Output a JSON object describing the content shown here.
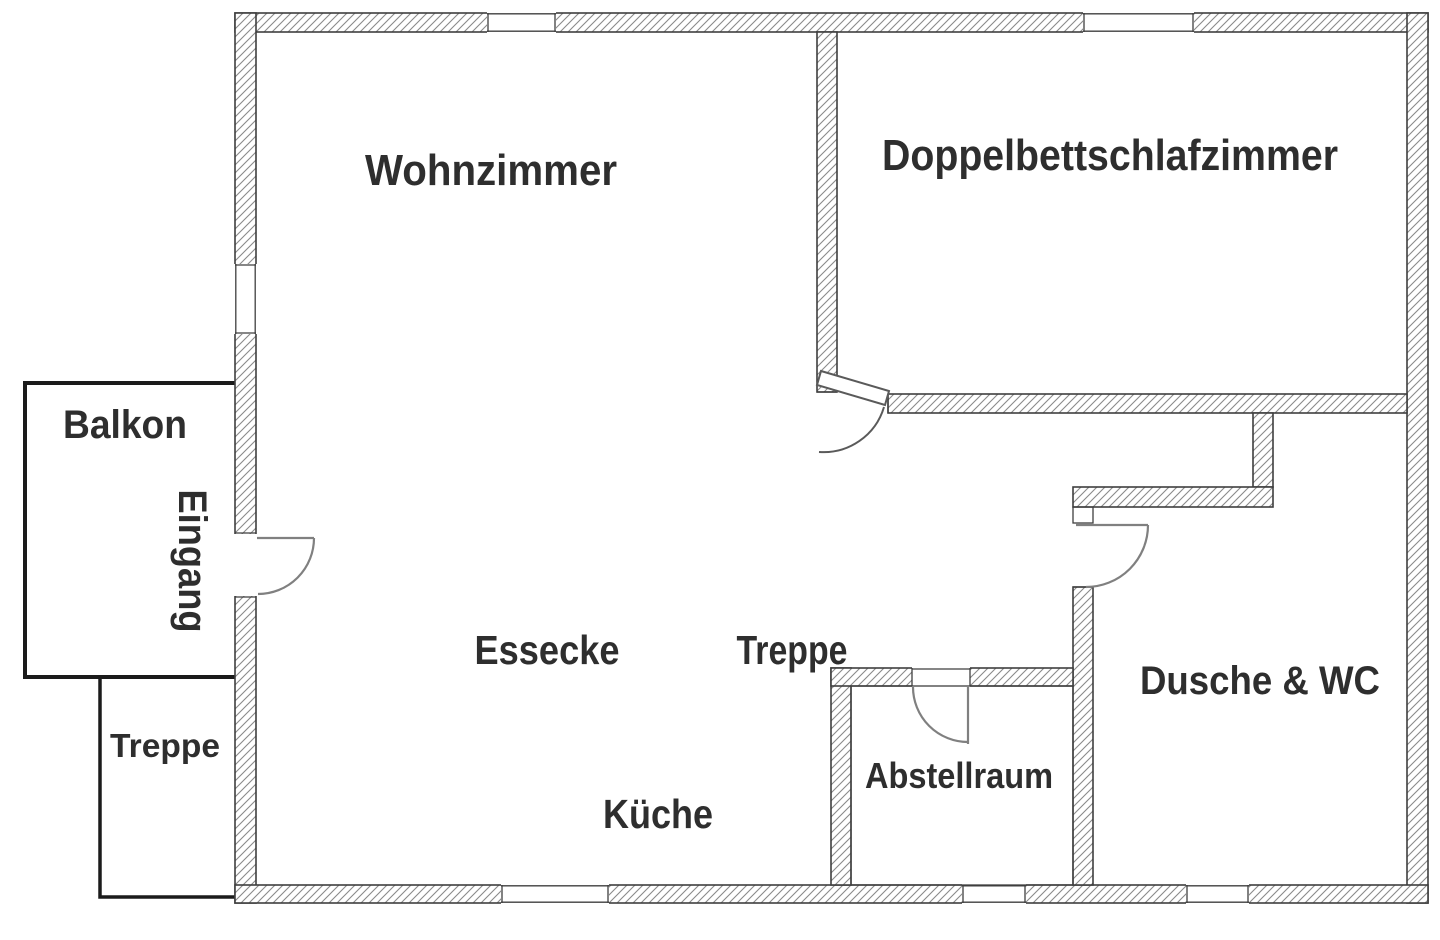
{
  "floorplan": {
    "title": "Apartment floor plan",
    "rooms": {
      "wohnzimmer": {
        "label": "Wohnzimmer"
      },
      "doppelbettschlafzimmer": {
        "label": "Doppelbettschlafzimmer"
      },
      "balkon": {
        "label": "Balkon"
      },
      "eingang": {
        "label": "Eingang"
      },
      "treppe_aussen": {
        "label": "Treppe"
      },
      "essecke": {
        "label": "Essecke"
      },
      "treppe_innen": {
        "label": "Treppe"
      },
      "kueche": {
        "label": "Küche"
      },
      "abstellraum": {
        "label": "Abstellraum"
      },
      "dusche_wc": {
        "label": "Dusche & WC"
      }
    },
    "colors": {
      "background": "#ffffff",
      "wall_outline": "#3f3f3f",
      "hatch": "#8a8a8a",
      "door_symbol": "#808080",
      "label_text": "#2e2e2e",
      "annex_outline": "#1b1b1b"
    }
  }
}
